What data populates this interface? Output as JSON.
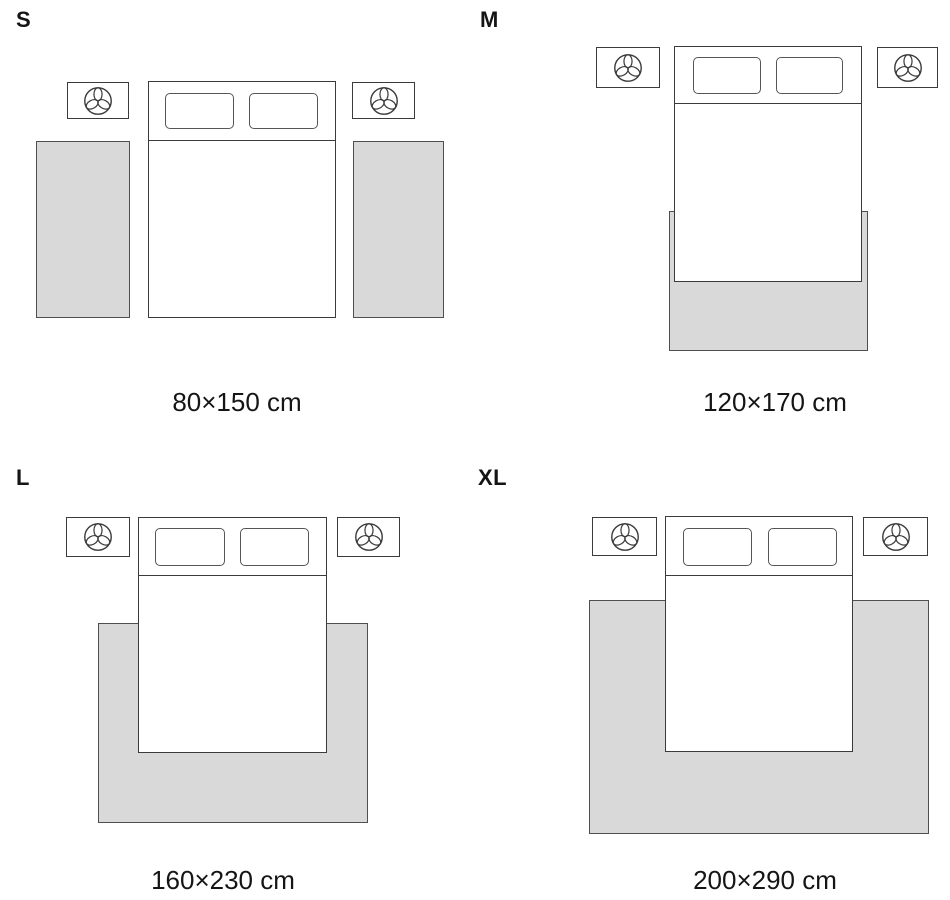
{
  "colors": {
    "rug_fill": "#d9d9d9",
    "rug_border": "#4f4f4f",
    "furniture_line": "#3b3b3b",
    "text": "#151515",
    "background": "#ffffff"
  },
  "panels": [
    {
      "id": "s",
      "label": "S",
      "caption": "80×150 cm"
    },
    {
      "id": "m",
      "label": "M",
      "caption": "120×170 cm"
    },
    {
      "id": "l",
      "label": "L",
      "caption": "160×230 cm"
    },
    {
      "id": "xl",
      "label": "XL",
      "caption": "200×290 cm"
    }
  ],
  "icons": {
    "nightstand_icon": "plant-icon"
  }
}
